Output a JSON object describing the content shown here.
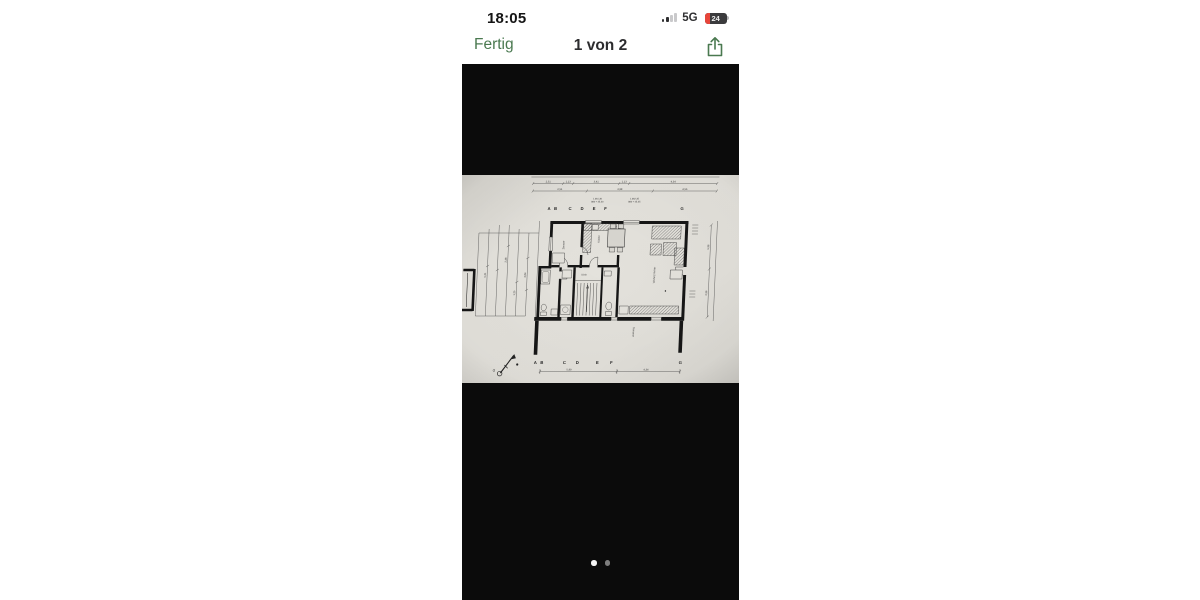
{
  "phone": {
    "status_bar": {
      "time": "18:05",
      "network": "5G",
      "battery_percent": "24"
    },
    "nav_bar": {
      "done_label": "Fertig",
      "title": "1 von 2",
      "accent_color": "#4a7950"
    },
    "viewer": {
      "background": "#0b0b0b",
      "page_count": 2,
      "active_page_index": 0
    },
    "floorplan": {
      "paper_color": "#e2e0da",
      "grid_letters_top": [
        "A",
        "B",
        "C",
        "D",
        "E",
        "F",
        "G"
      ],
      "grid_letters_bottom": [
        "A",
        "B",
        "C",
        "D",
        "E",
        "F",
        "G"
      ],
      "dims_top_row1": [
        "2,51",
        "1,13",
        "3,41",
        "1,13",
        "4,34"
      ],
      "dims_top_row2": [
        "2,51",
        "3,98",
        "4,56"
      ],
      "elevation_note_left": [
        "1.061,30",
        "860 + 35,30"
      ],
      "elevation_note_right": [
        "1.062,35",
        "860 + 45,35"
      ],
      "dims_bottom": [
        "5,99",
        "4,34"
      ],
      "dims_left": [
        "5,21",
        "2,38",
        "1,25",
        "3,64"
      ],
      "dims_right": [
        "5,96",
        "2,96"
      ],
      "compass_label": "O",
      "room_labels": {
        "bedroom": "Zimmer",
        "kitchen": "Küche",
        "living": "Wohnzimmer",
        "hall": "Diele",
        "terrace": "Terrasse"
      }
    }
  }
}
